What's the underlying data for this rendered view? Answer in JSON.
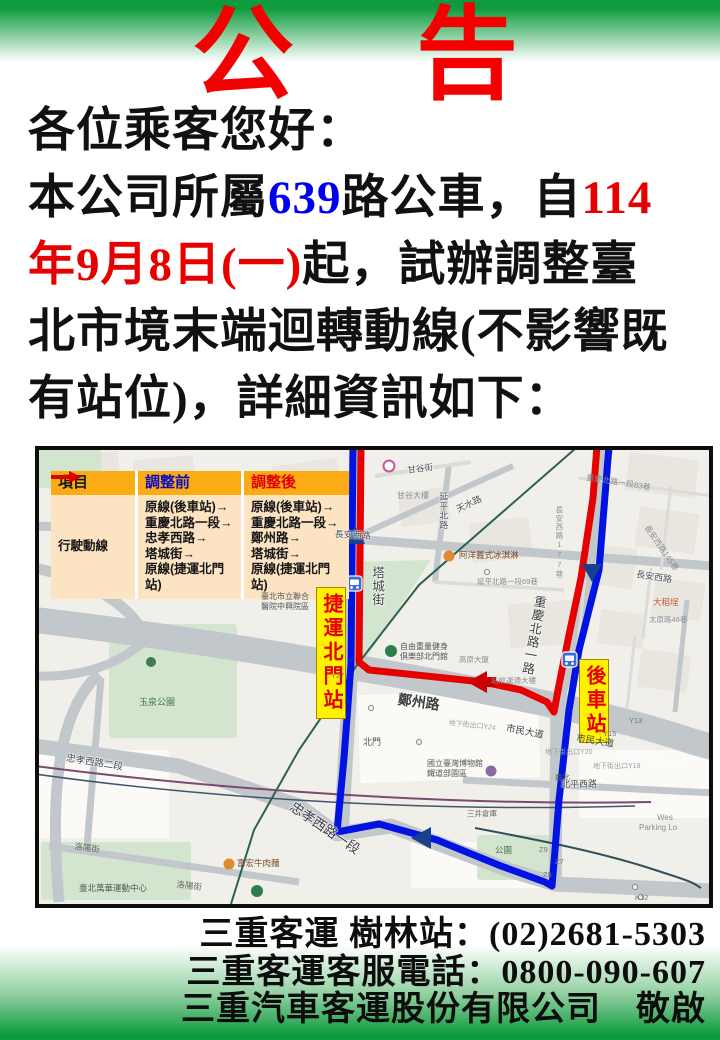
{
  "poster": {
    "title": "公　告",
    "colors": {
      "banner_green": "#0d9b3d",
      "title_red": "#f40000",
      "highlight_blue": "#0000ee",
      "highlight_red": "#e60000",
      "route_red": "#e60000",
      "route_blue": "#0013e0",
      "legend_header_bg": "#fbac15",
      "legend_body_bg": "#fce3c2",
      "station_label_yellow": "#fff100"
    }
  },
  "announcement": {
    "line1": "各位乘客您好：",
    "line2_black1": "本公司所屬",
    "line2_blue": "639",
    "line2_black2": "路公車，自",
    "line2_red": "114",
    "line3_red": "年9月8日(一)",
    "line3_black": "起，試辦調整臺",
    "line4": "北市境末端迴轉動線(不影響既",
    "line5": "有站位)，詳細資訊如下："
  },
  "legend": {
    "col_item": "項目",
    "col_before": "調整前",
    "col_after": "調整後",
    "row_header": "行駛動線",
    "before_lines": [
      "原線(後車站)→",
      "重慶北路一段→",
      "忠孝西路→",
      "塔城街→",
      "原線(捷運北門站)"
    ],
    "after_lines": [
      "原線(後車站)→",
      "重慶北路一段→",
      "鄭州路→",
      "塔城街→",
      "原線(捷運北門站)"
    ]
  },
  "map": {
    "station_labels": {
      "north_gate": "捷運北門站",
      "rear_station": "後車站"
    },
    "labels": {
      "changan_w": "長安西路",
      "changan_e": "長安西路",
      "tianshui": "天水路",
      "yanping_n": "延平北路",
      "gangu_st": "甘谷街",
      "gangu_bld": "甘谷大樓",
      "changan177": "長安西路177巷",
      "chongqing83": "重慶北路一段83巷",
      "changan145": "長安西路145巷",
      "tacheng_st": "塔城街",
      "chongqing_rd": "重慶北路一路",
      "yanping69": "延平北路一段69巷",
      "dadaocheng": "大稻埕",
      "taiyuan48": "太原路48巷",
      "icecream": "阿洋義式冰淇淋",
      "hospital_l1": "臺北市立聯合",
      "hospital_l2": "醫院中興院區",
      "gym_l1": "自由重量健身",
      "gym_l2": "俱樂部北門館",
      "gaoyuan": "高原大廈",
      "station_bld": "站前運通大樓",
      "zhengzhou": "鄭州路",
      "shimin": "市民大道",
      "y27": "Y27",
      "y13": "Y13",
      "y15": "Y15",
      "z9": "Z9",
      "z7": "Z7",
      "z5": "Z5",
      "k12": "K12",
      "yuquan": "玉泉公園",
      "zhongxiao1": "忠孝西路一段",
      "zhongxiao2": "忠孝西路二段",
      "luoyang": "洛陽街",
      "sports": "臺北萬華運動中心",
      "beef": "富宏牛肉麵",
      "beimen": "北門",
      "museum_l1": "國立臺灣博物館",
      "museum_l2": "鐵道部園區",
      "mitsui": "三井倉庫",
      "park": "公園",
      "west_l1": "Wes",
      "west_l2": "Parking Lo",
      "underpass_y24": "地下街出口Y24",
      "underpass_y20": "地下街出口Y20",
      "underpass_y18": "地下街出口Y18",
      "expressway": "台北市東西向快速道路",
      "taipei": "臺北",
      "beiping": "北平西路"
    }
  },
  "contact": {
    "line1": "三重客運 樹林站：(02)2681-5303",
    "line2": "三重客運客服電話：0800-090-607",
    "line3": "三重汽車客運股份有限公司　敬啟"
  }
}
